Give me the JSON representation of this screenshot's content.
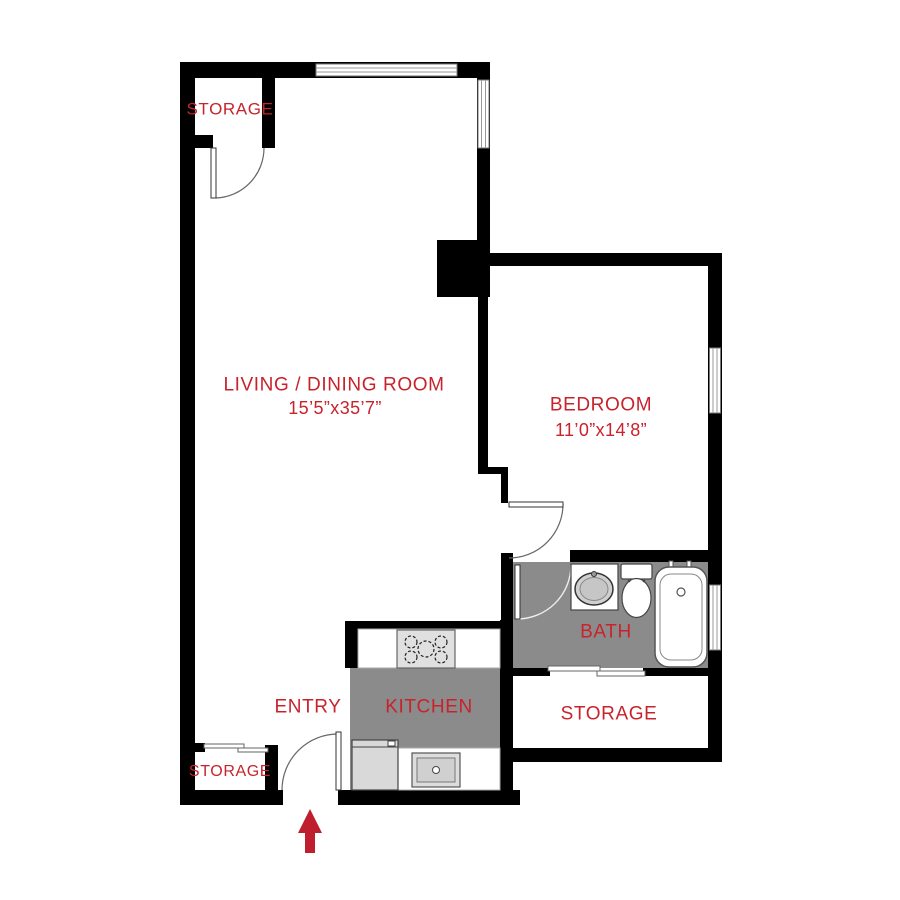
{
  "plan": {
    "rooms": {
      "storage_top_left": {
        "label": "STORAGE"
      },
      "living_dining": {
        "label": "LIVING / DINING ROOM",
        "dimensions": "15’5”x35’7”"
      },
      "bedroom": {
        "label": "BEDROOM",
        "dimensions": "11’0”x14’8”"
      },
      "bath": {
        "label": "BATH"
      },
      "kitchen": {
        "label": "KITCHEN"
      },
      "entry": {
        "label": "ENTRY"
      },
      "storage_right": {
        "label": "STORAGE"
      },
      "storage_bottom_left": {
        "label": "STORAGE"
      }
    },
    "icons": {
      "entry_arrow": "up-arrow"
    },
    "colors": {
      "wall": "#000000",
      "label_text": "#c8232c",
      "entry_arrow": "#be1e2d",
      "wet_floor": "#8b8b8b",
      "fixture_gray": "#d9d9d9"
    }
  }
}
